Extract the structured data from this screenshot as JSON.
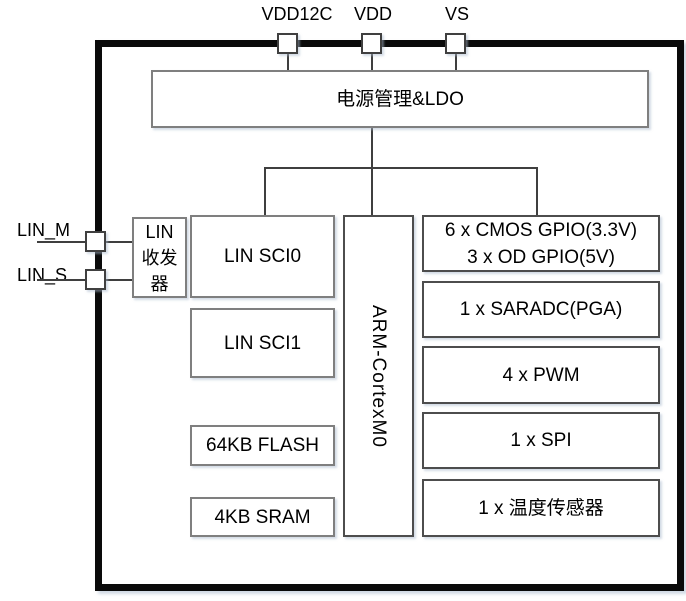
{
  "colors": {
    "chip_border": "#0a0a0a",
    "block_border_light": "#7f7f7f",
    "block_border_dark": "#4d4d4d",
    "connector": "#3f3f3f",
    "background": "#ffffff"
  },
  "pins": {
    "top": [
      {
        "label": "VDD12C"
      },
      {
        "label": "VDD"
      },
      {
        "label": "VS"
      }
    ],
    "left": [
      {
        "label": "LIN_M"
      },
      {
        "label": "LIN_S"
      }
    ]
  },
  "blocks": {
    "power": {
      "label": "电源管理&LDO"
    },
    "lin_transceiver": {
      "lines": [
        "LIN",
        "收发",
        "器"
      ]
    },
    "lin_sci0": {
      "label": "LIN SCI0"
    },
    "lin_sci1": {
      "label": "LIN SCI1"
    },
    "flash": {
      "label": "64KB FLASH"
    },
    "sram": {
      "label": "4KB SRAM"
    },
    "cpu": {
      "label": "ARM-CortexM0"
    },
    "gpio": {
      "lines": [
        "6 x CMOS GPIO(3.3V)",
        "3 x OD GPIO(5V)"
      ]
    },
    "adc": {
      "label": "1 x SARADC(PGA)"
    },
    "pwm": {
      "label": "4 x PWM"
    },
    "spi": {
      "label": "1 x SPI"
    },
    "temp_sensor": {
      "label": "1 x 温度传感器"
    }
  }
}
